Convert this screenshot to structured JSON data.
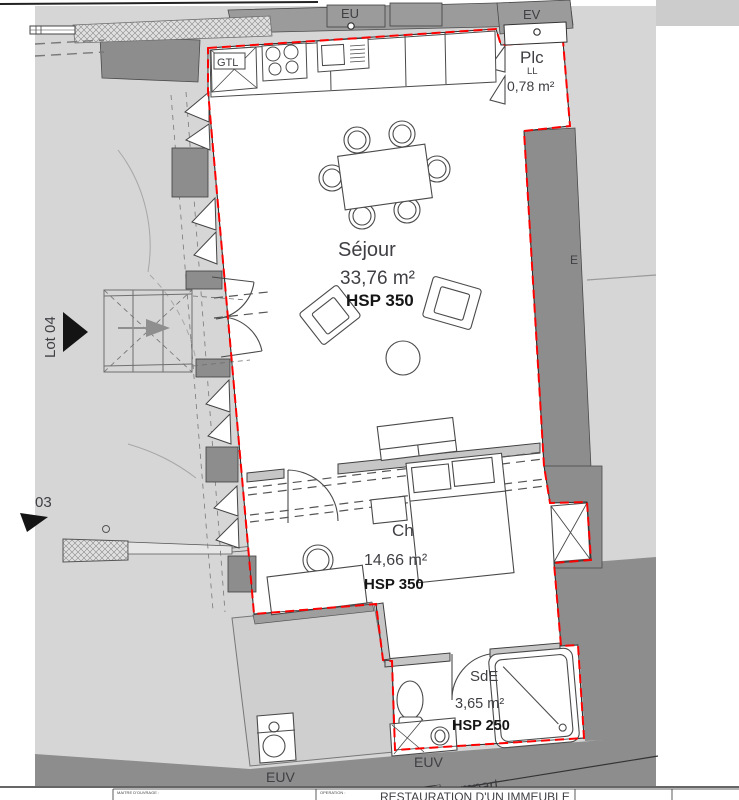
{
  "drawing": {
    "rooms": {
      "sejour": {
        "name": "Séjour",
        "area": "33,76 m²",
        "hsp": "HSP 350"
      },
      "chambre": {
        "name": "Ch",
        "area": "14,66 m²",
        "hsp": "HSP 350"
      },
      "sde": {
        "name": "SdE",
        "area": "3,65 m²",
        "hsp": "HSP 250"
      },
      "placard": {
        "name": "Plc",
        "appliance": "LL",
        "area": "0,78 m²"
      }
    },
    "annotations": {
      "eu": "EU",
      "ev": "EV",
      "euv_left": "EUV",
      "euv_right": "EUV",
      "gtl": "GTL",
      "lot": "Lot 04",
      "lot_adjacent": "03",
      "east": "E",
      "street": "rempart"
    },
    "colors": {
      "boundary_red": "#ff0000",
      "field_gray": "#d6d6d6",
      "wall_dark": "#8d8d8d",
      "wall_mid": "#c6c6c6",
      "street_gray": "#909090"
    }
  },
  "titleblock": {
    "client_label": "MAITRE D'OUVRAGE :",
    "operation_label": "OPERATION :",
    "operation_value": "RESTAURATION D'UN IMMEUBLE"
  }
}
